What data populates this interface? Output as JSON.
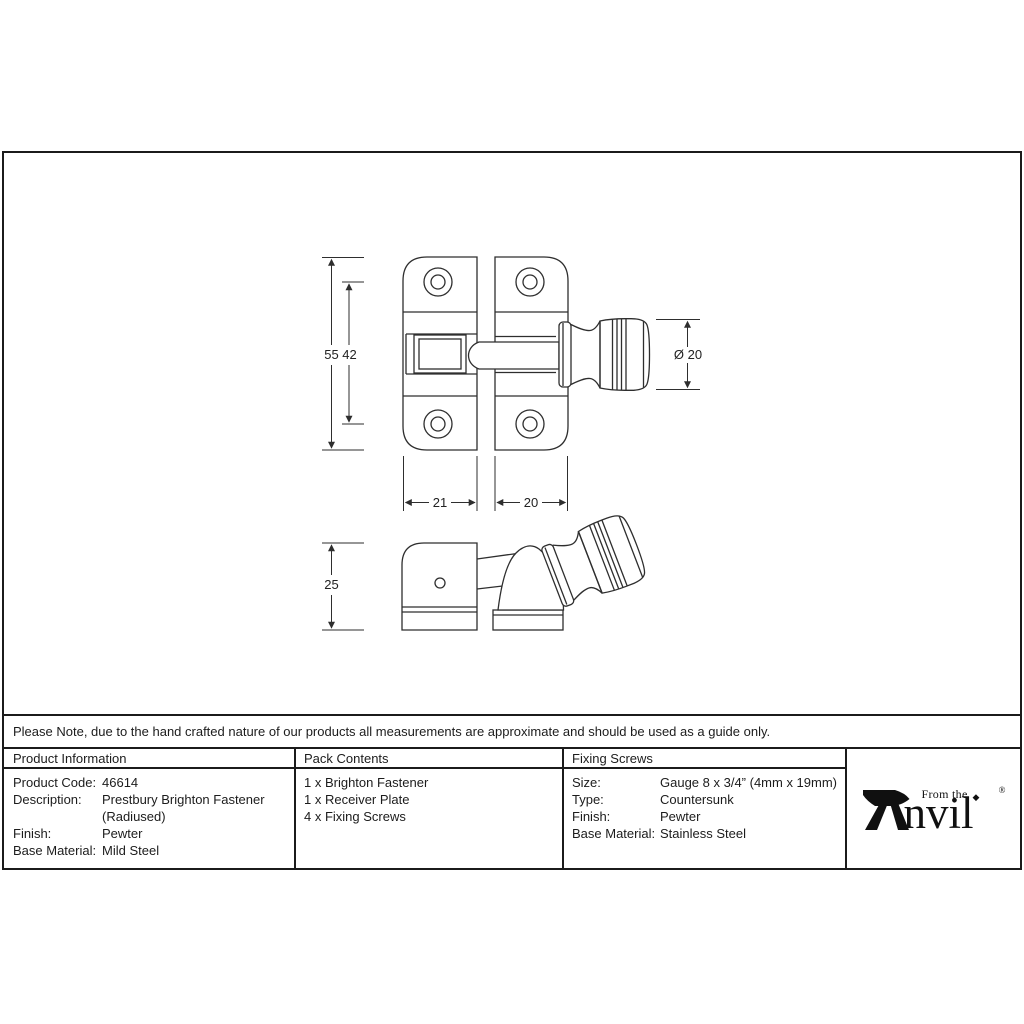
{
  "drawing": {
    "front_view": {
      "dim_overall_height": "55",
      "dim_hole_spacing": "42",
      "dim_knob_diameter": "Ø 20",
      "dim_left_plate_width": "21",
      "dim_right_plate_width": "20"
    },
    "side_view": {
      "dim_depth": "25"
    }
  },
  "note": "Please Note, due to the hand crafted nature of our products all measurements are approximate and should be used as a guide only.",
  "product_information": {
    "header": "Product Information",
    "rows": [
      {
        "label": "Product Code:",
        "value": "46614"
      },
      {
        "label": "Description:",
        "value": "Prestbury Brighton Fastener\n(Radiused)"
      },
      {
        "label": "Finish:",
        "value": "Pewter"
      },
      {
        "label": "Base Material:",
        "value": "Mild Steel"
      }
    ]
  },
  "pack_contents": {
    "header": "Pack Contents",
    "items": [
      "1 x Brighton Fastener",
      "1 x Receiver Plate",
      "4 x Fixing Screws"
    ]
  },
  "fixing_screws": {
    "header": "Fixing Screws",
    "rows": [
      {
        "label": "Size:",
        "value": "Gauge 8 x 3/4” (4mm x 19mm)"
      },
      {
        "label": "Type:",
        "value": "Countersunk"
      },
      {
        "label": "Finish:",
        "value": "Pewter"
      },
      {
        "label": "Base Material:",
        "value": "Stainless Steel"
      }
    ]
  },
  "logo": {
    "tagline": "From the",
    "wordmark_suffix": "nvil",
    "diamond": "◆",
    "registered": "®"
  },
  "colors": {
    "line": "#2e2e2e",
    "border": "#1b1b1b",
    "ink": "#1c1c1c"
  }
}
